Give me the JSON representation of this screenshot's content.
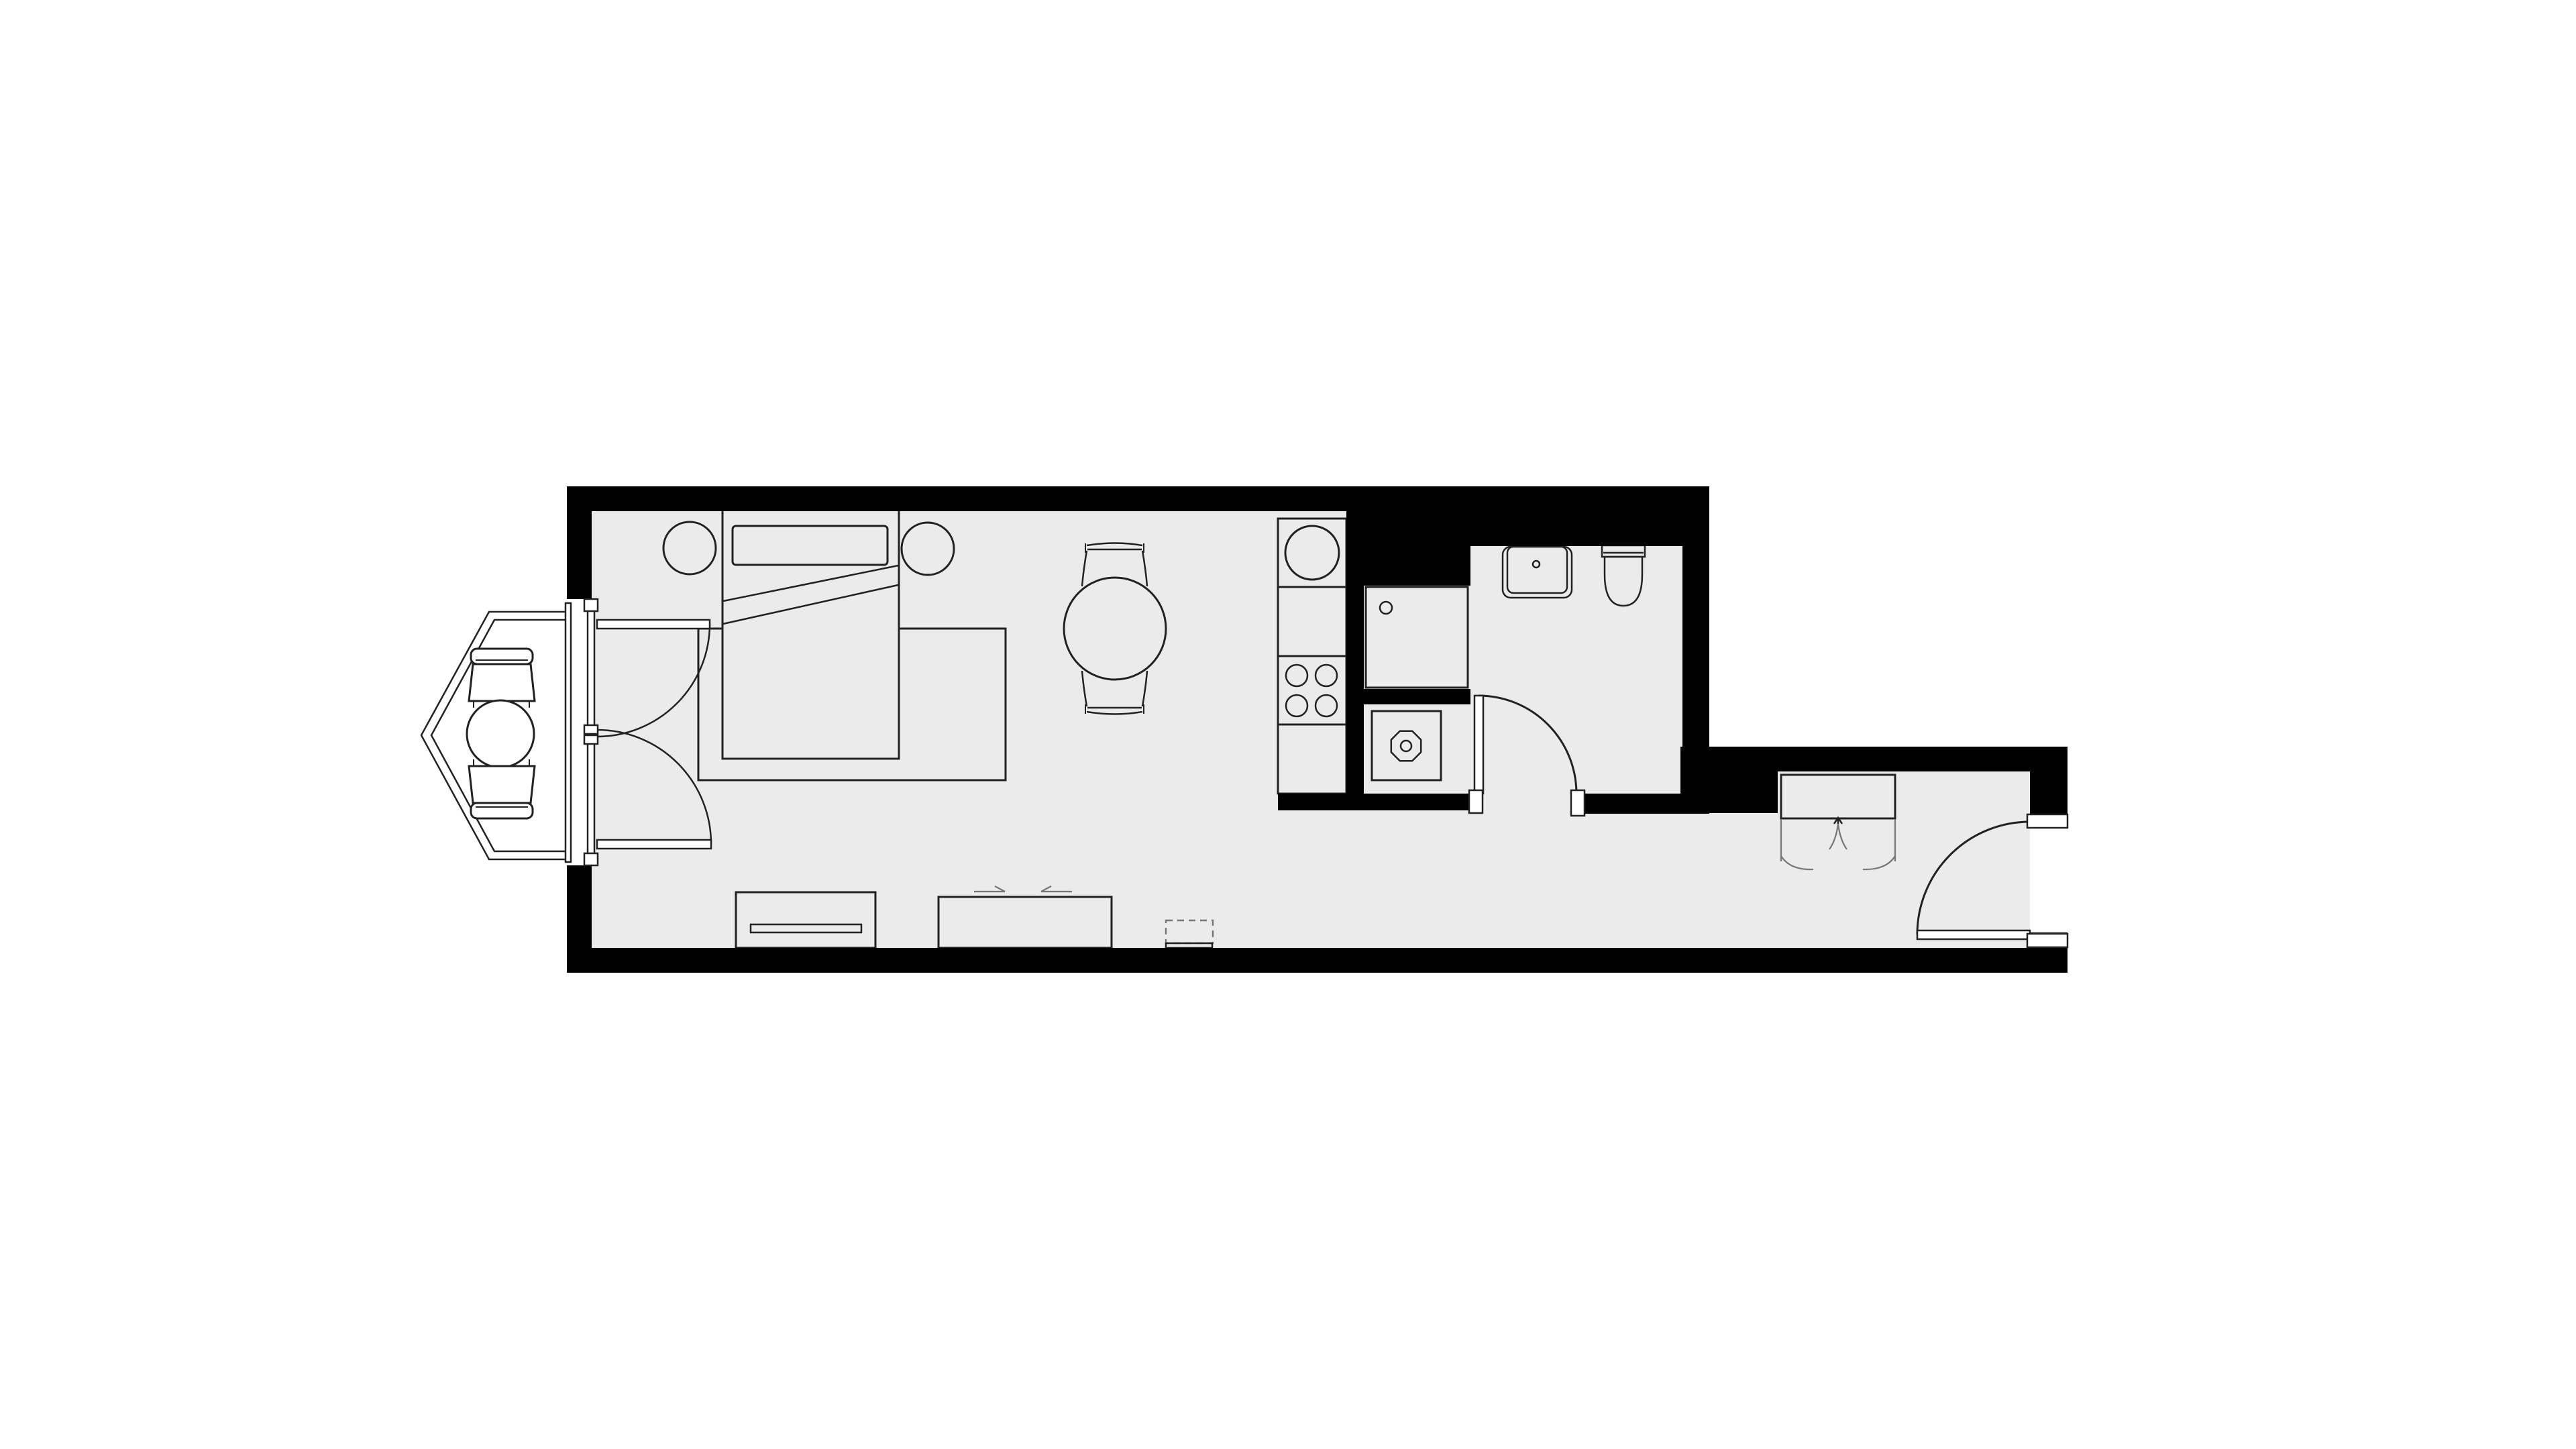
{
  "title": "Studio apartment floor plan",
  "colors": {
    "background": "#ffffff",
    "floor": "#ebebeb",
    "wall": "#000000",
    "line": "#222222",
    "line_soft": "#777777",
    "white": "#ffffff"
  },
  "legend": {
    "rooms": [
      {
        "id": "main-room",
        "label": "Main living and sleeping room"
      },
      {
        "id": "kitchenette",
        "label": "Kitchenette counter run"
      },
      {
        "id": "bathroom",
        "label": "Bathroom"
      },
      {
        "id": "hallway",
        "label": "Entrance hallway"
      },
      {
        "id": "bay-window",
        "label": "Bay window seating nook"
      }
    ],
    "furniture": [
      {
        "id": "double-bed",
        "label": "Double bed with pillow and folded blanket"
      },
      {
        "id": "nightstands",
        "label": "Round bedside tables flanking the bed"
      },
      {
        "id": "rug",
        "label": "Area rug under the bed"
      },
      {
        "id": "dining-set",
        "label": "Round dining table with two chairs"
      },
      {
        "id": "bay-seating",
        "label": "Round table with two armchairs in the bay"
      },
      {
        "id": "sideboard",
        "label": "Low sideboard against the bottom wall"
      },
      {
        "id": "sliding-cabinet",
        "label": "Cabinet with sliding doors"
      },
      {
        "id": "radiator",
        "label": "Dashed wall-mounted unit"
      },
      {
        "id": "wardrobe",
        "label": "Hallway wardrobe with clothes rail"
      }
    ],
    "fixtures": [
      {
        "id": "kitchen-sink",
        "label": "Round kitchen sink basin"
      },
      {
        "id": "cooktop",
        "label": "Four-burner cooktop"
      },
      {
        "id": "shower",
        "label": "Shower tray with corner drain"
      },
      {
        "id": "washing-machine",
        "label": "Washing machine"
      },
      {
        "id": "bathroom-sink",
        "label": "Wash basin with tap"
      },
      {
        "id": "toilet",
        "label": "Toilet with cistern"
      }
    ],
    "openings": [
      {
        "id": "french-doors",
        "label": "Double french doors opening from the bay window"
      },
      {
        "id": "bathroom-door",
        "label": "Bathroom door swinging inward"
      },
      {
        "id": "entrance-door",
        "label": "Apartment entrance door swinging inward"
      }
    ]
  }
}
